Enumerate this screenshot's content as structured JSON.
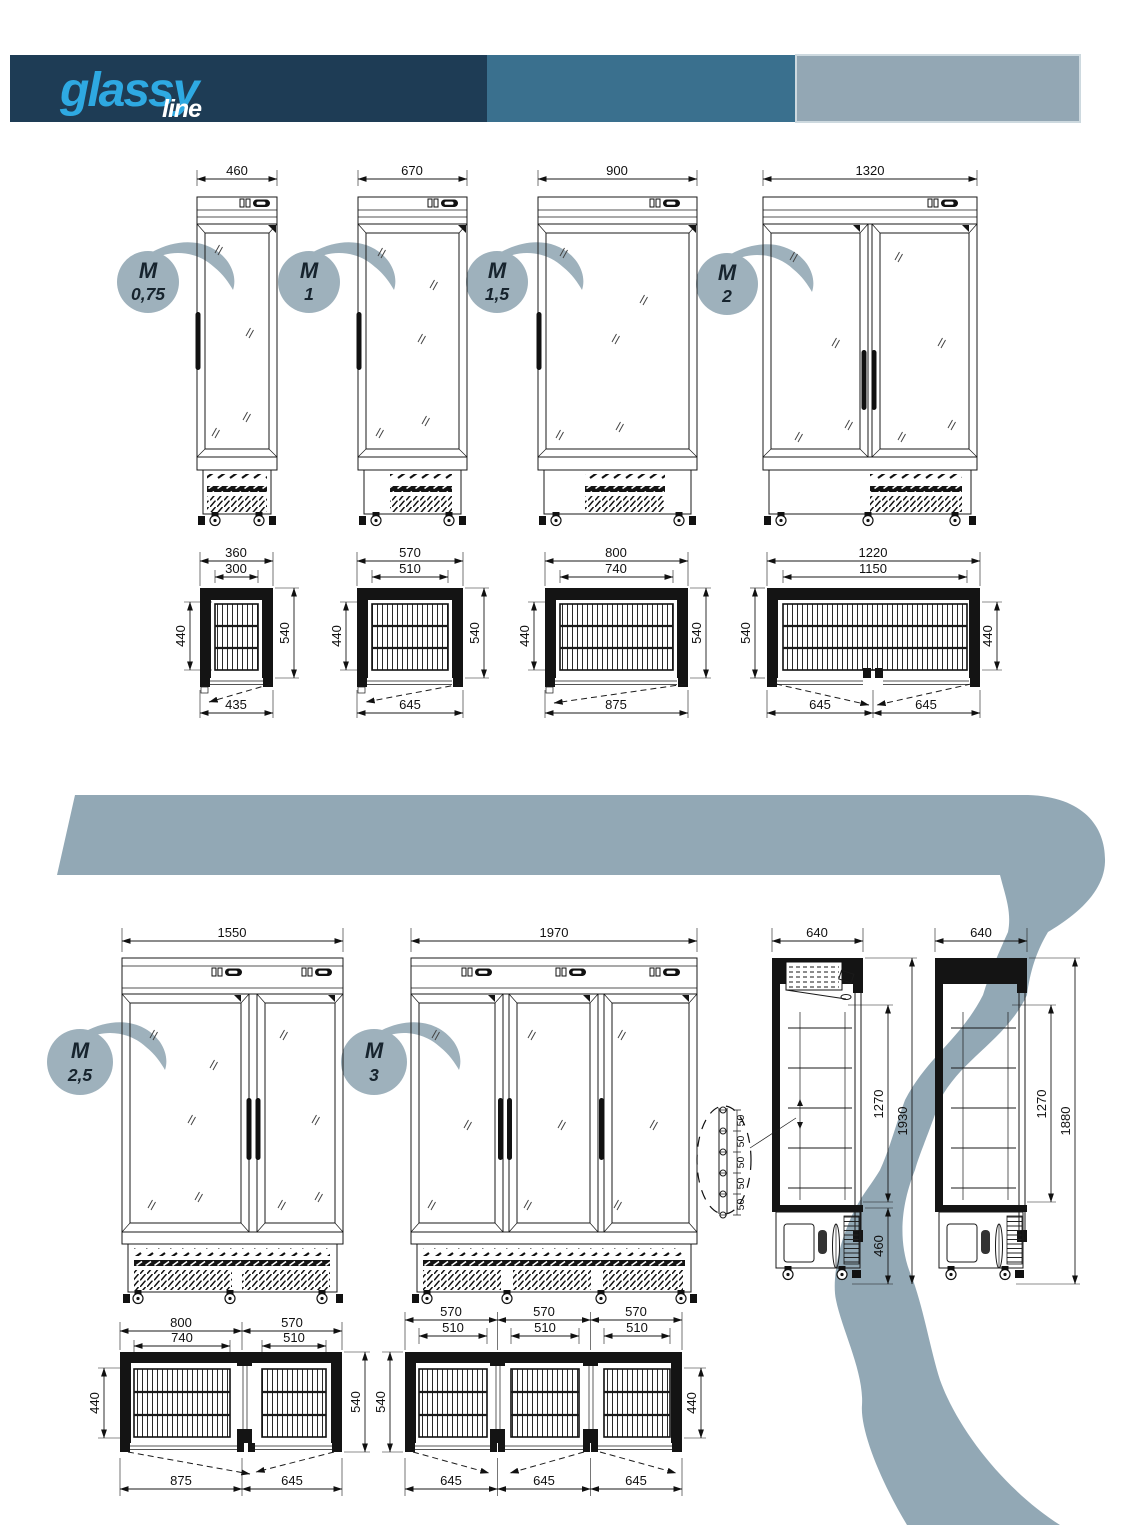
{
  "logo": {
    "name": "glassy",
    "sub": "line"
  },
  "models": [
    {
      "badge_m": "M",
      "badge_size": "0,75",
      "front_width": "460"
    },
    {
      "badge_m": "M",
      "badge_size": "1",
      "front_width": "670"
    },
    {
      "badge_m": "M",
      "badge_size": "1,5",
      "front_width": "900"
    },
    {
      "badge_m": "M",
      "badge_size": "2",
      "front_width": "1320"
    },
    {
      "badge_m": "M",
      "badge_size": "2,5",
      "front_width": "1550"
    },
    {
      "badge_m": "M",
      "badge_size": "3",
      "front_width": "1970"
    }
  ],
  "plans_row1": [
    {
      "outer": "360",
      "inner": "300",
      "left": "440",
      "right": "540",
      "swings": [
        "435"
      ]
    },
    {
      "outer": "570",
      "inner": "510",
      "left": "440",
      "right": "540",
      "swings": [
        "645"
      ]
    },
    {
      "outer": "800",
      "inner": "740",
      "left": "440",
      "right": "540",
      "swings": [
        "875"
      ]
    },
    {
      "outer": "1220",
      "inner": "1150",
      "left": "540",
      "right": "440",
      "swings": [
        "645",
        "645"
      ]
    }
  ],
  "plans_row2": [
    {
      "outers": [
        "800",
        "570"
      ],
      "inners": [
        "740",
        "510"
      ],
      "left": "440",
      "right": "540",
      "swings": [
        "875",
        "645"
      ]
    },
    {
      "outers": [
        "570",
        "570",
        "570"
      ],
      "inners": [
        "510",
        "510",
        "510"
      ],
      "left": "540",
      "right": "440",
      "swings": [
        "645",
        "645",
        "645"
      ]
    }
  ],
  "side_views": [
    {
      "width": "640",
      "interior": "1270",
      "total": "1930",
      "base": "460",
      "pitch": [
        "50",
        "50",
        "50",
        "50",
        "50"
      ]
    },
    {
      "width": "640",
      "interior": "1270",
      "total": "1880"
    }
  ],
  "colors": {
    "header_dark": "#1e3c55",
    "header_mid": "#3a708e",
    "header_gray": "#93a7b4",
    "logo_accent": "#2ea9e2",
    "badge": "#9eb1bc",
    "swoosh": "#92a8b5"
  }
}
